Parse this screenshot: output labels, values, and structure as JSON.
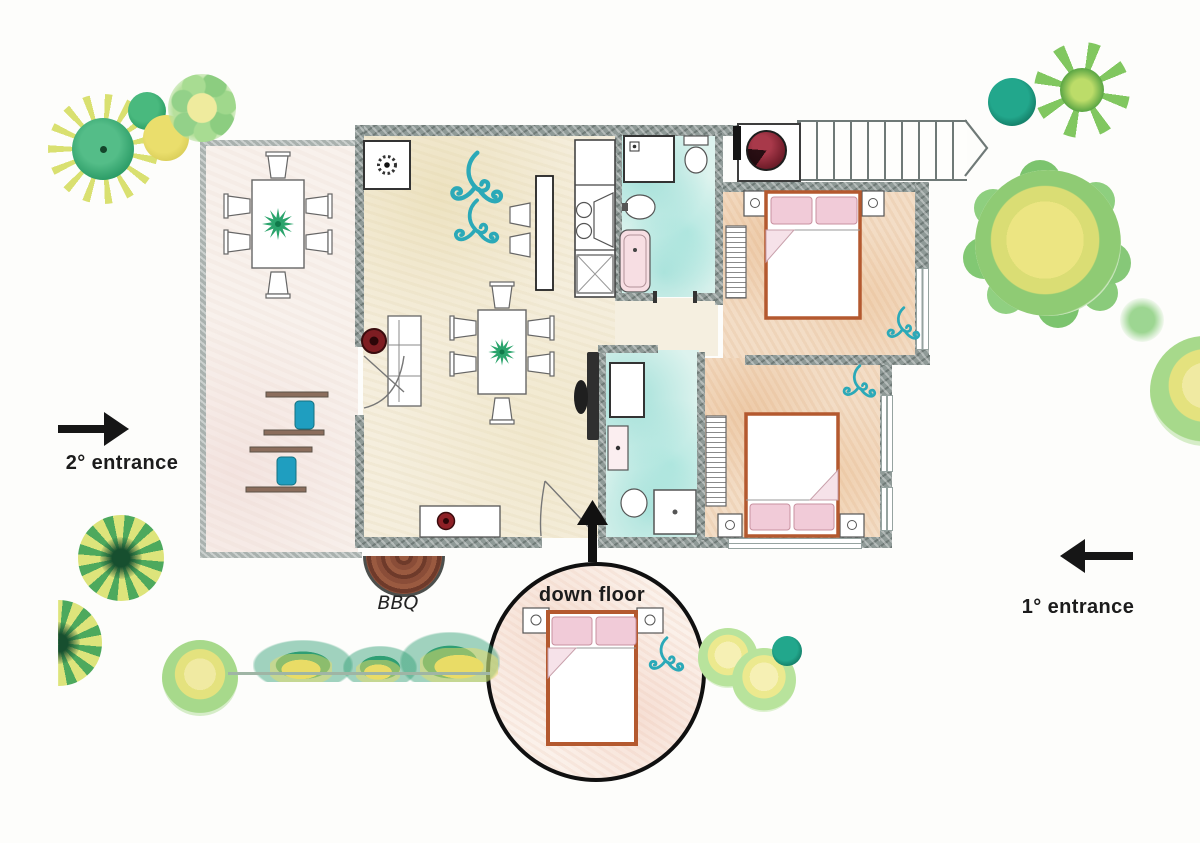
{
  "scene": {
    "type": "watercolor apartment floor plan",
    "style": "hand-drawn pencil and watercolor"
  },
  "labels": {
    "entrance_2": "2° entrance",
    "entrance_1": "1° entrance",
    "bbq": "BBQ",
    "down_floor": "down floor"
  },
  "arrows": {
    "entrance_2_arrow_direction": "right",
    "entrance_1_arrow_direction": "left",
    "down_floor_arrow_direction": "up",
    "stairs_arrow_direction": "right"
  },
  "icons": {
    "ac_swirl": "wind-swirl",
    "extractor_fan": "fan-rosette",
    "plant": "star-leaf-plant",
    "washer": "round-door-machine"
  },
  "colors": {
    "wall_gray": "#8f9a97",
    "terrace_wall": "#a9b1ae",
    "living_floor": "#f5eedd",
    "terrace_floor": "#f8f1ec",
    "bedroom_floor": "#f3ddc6",
    "bathroom_floor": "#cdeee6",
    "bed_frame_brown": "#b4592f",
    "pillow_pink": "#f1cbd8",
    "lounger_cushion_blue": "#1f9ec0",
    "ac_swirl_teal": "#2ba9b8",
    "bbq_brick": "#8a4d38",
    "pot_red": "#7e1d22",
    "plant_green": "#2aa46c",
    "tree_green": "#86c878",
    "tree_yellow": "#ece582",
    "arrow_black": "#161616"
  }
}
